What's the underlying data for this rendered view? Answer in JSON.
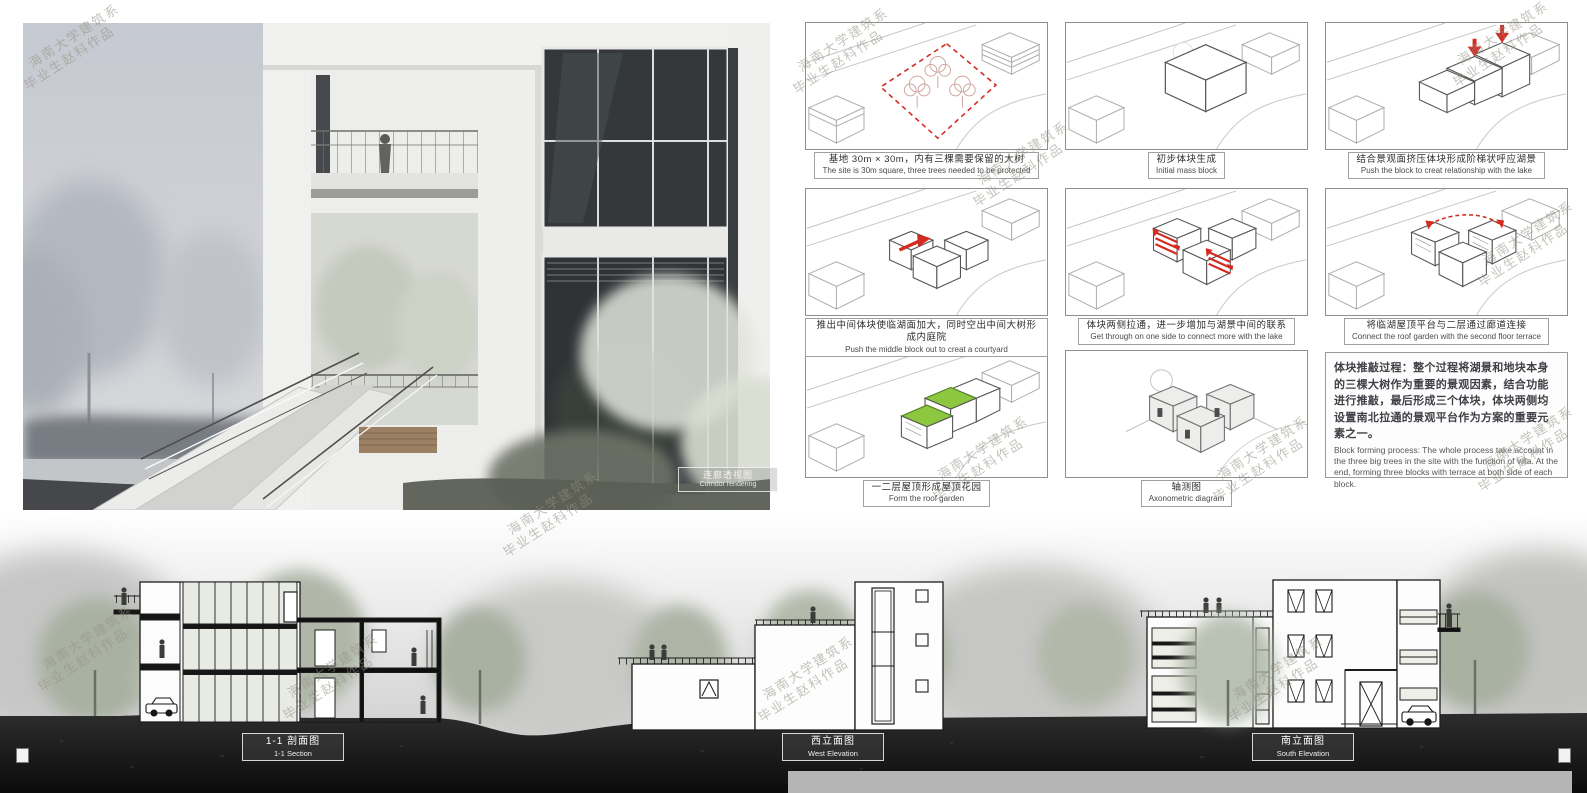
{
  "watermark": {
    "line1": "海南大学建筑系",
    "line2": "毕业生赵科作品"
  },
  "rendering": {
    "label_cn": "连廊透视图",
    "label_en": "Corridor rendering"
  },
  "diagrams": {
    "panels": [
      {
        "name": "site-with-trees",
        "caption_cn": "基地 30m × 30m，内有三棵需要保留的大树",
        "caption_en": "The site is 30m square, three trees needed to be protected"
      },
      {
        "name": "initial-mass-block",
        "caption_cn": "初步体块生成",
        "caption_en": "Initial mass block"
      },
      {
        "name": "stepped-block-to-lake",
        "caption_cn": "结合景观面挤压体块形成阶梯状呼应湖景",
        "caption_en": "Push the block to creat relationship with the lake"
      },
      {
        "name": "push-middle-block-courtyard",
        "caption_cn": "推出中间体块使临湖面加大，同时空出中间大树形成内庭院",
        "caption_en": "Push the middle block out to creat a courtyard"
      },
      {
        "name": "get-through-sides",
        "caption_cn": "体块两侧拉通，进一步增加与湖景中间的联系",
        "caption_en": "Get through on one side to connect more with the lake"
      },
      {
        "name": "connect-roof-garden",
        "caption_cn": "将临湖屋顶平台与二层通过廊道连接",
        "caption_en": "Connect the roof garden with the second floor terrace"
      },
      {
        "name": "roof-garden",
        "caption_cn": "一二层屋顶形成屋顶花园",
        "caption_en": "Form the roof garden"
      },
      {
        "name": "axonometric",
        "caption_cn": "轴测图",
        "caption_en": "Axonometric diagram"
      }
    ],
    "note": {
      "cn": "体块推敲过程：整个过程将湖景和地块本身的三棵大树作为重要的景观因素，结合功能进行推敲，最后形成三个体块，体块两侧均设置南北拉通的景观平台作为方案的重要元素之一。",
      "en": "Block forming process: The whole process take account in the three big trees in the site with the function of villa. At the end, forming three blocks with terrace at both side of each block."
    }
  },
  "elevations": {
    "labels": [
      {
        "cn": "1-1 剖面图",
        "en": "1-1 Section"
      },
      {
        "cn": "西立面图",
        "en": "West Elevation"
      },
      {
        "cn": "南立面图",
        "en": "South Elevation"
      }
    ]
  },
  "colors": {
    "accent_red": "#d42a20",
    "roof_green": "#8dc63f",
    "ground_dark": "#161616",
    "caption_border": "#9a9a9a"
  }
}
